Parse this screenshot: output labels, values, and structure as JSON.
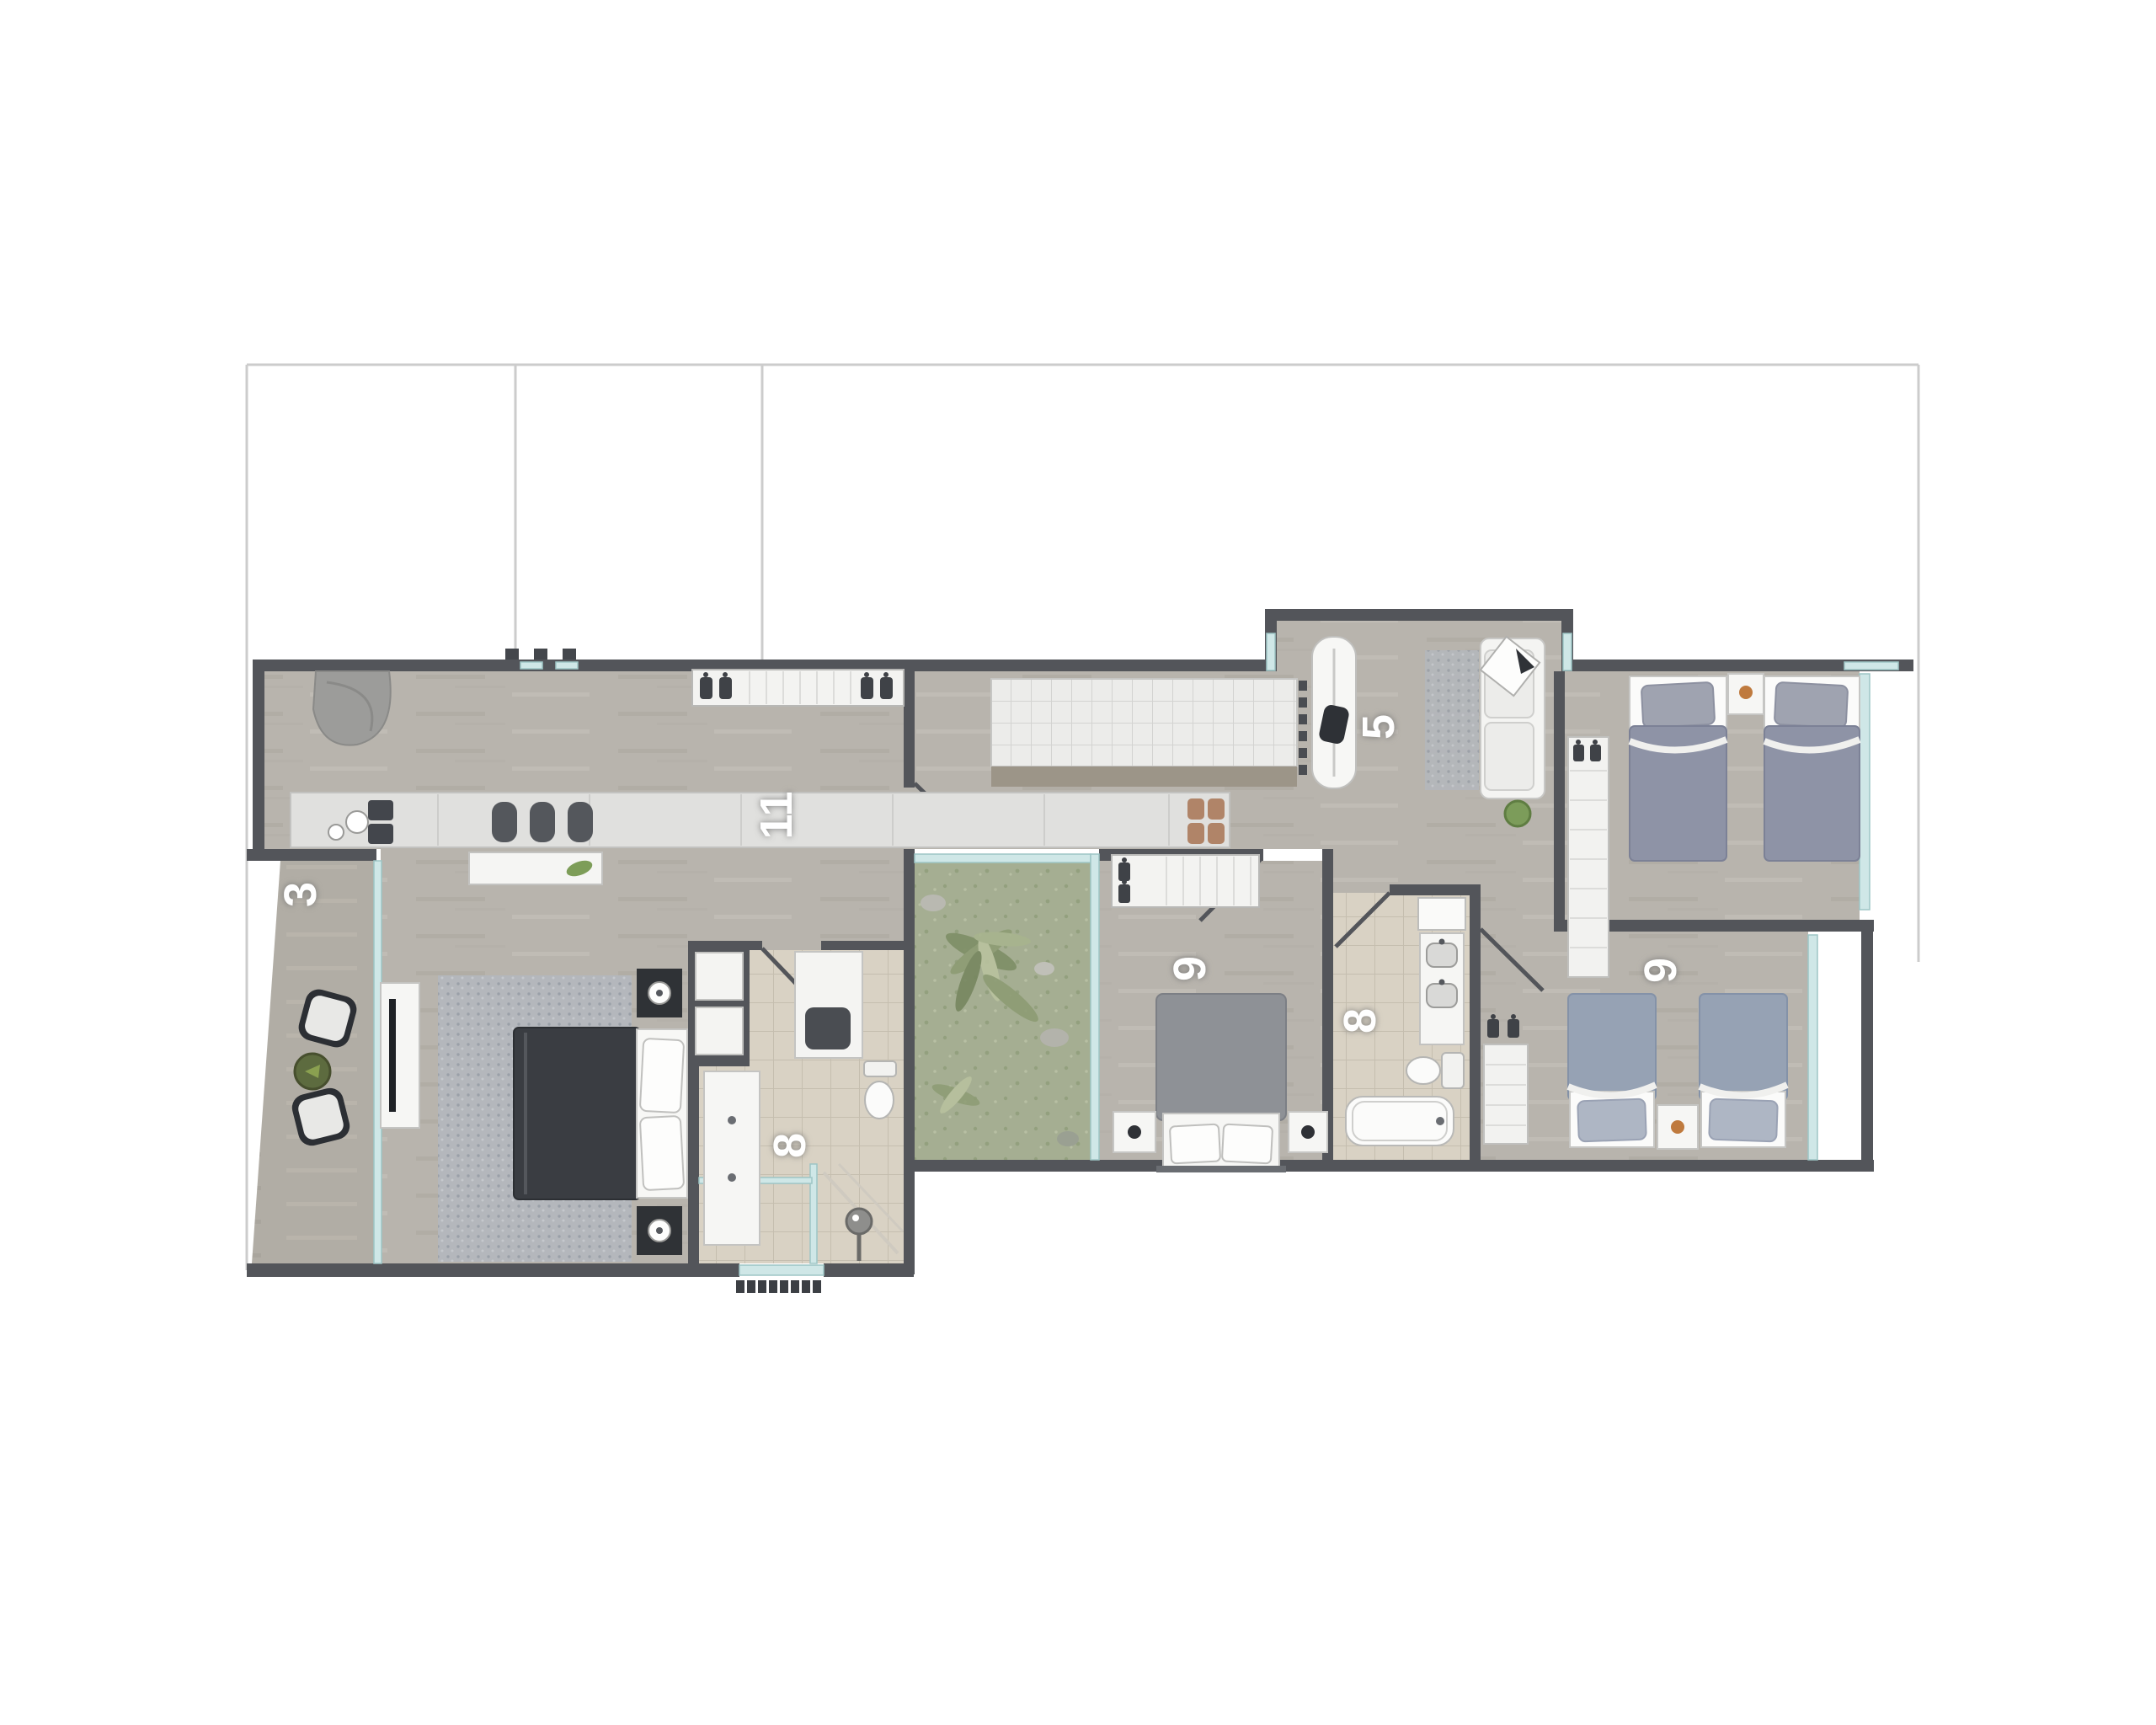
{
  "plan": {
    "type": "apartment-floor-plan",
    "background": "#ffffff",
    "rooms": [
      {
        "label": "3",
        "name": "terrace"
      },
      {
        "label": "11",
        "name": "living-kitchen"
      },
      {
        "label": "5",
        "name": "utility-room"
      },
      {
        "label": "9",
        "name": "bedroom-center"
      },
      {
        "label": "8",
        "name": "bathroom-master"
      },
      {
        "label": "8",
        "name": "bathroom-shared"
      },
      {
        "label": "9",
        "name": "bedroom-right"
      }
    ],
    "palette": {
      "wall": "#53555a",
      "wood_floor": "#b8b4ad",
      "terrace_floor": "#b1ada5",
      "bathroom_tile": "#d9d2c4",
      "garden_grass": "#a5ae92",
      "glass_window": "#cfe7e7",
      "boundary_line": "#cccccc",
      "label_text": "#ffffff",
      "white_furniture": "#f5f5f3",
      "dark_furniture": "#3a3d42",
      "bed_gray_blue": "#8e93a6",
      "accent_green": "#7d9d58",
      "accent_orange": "#bf7a3e"
    },
    "icons": [
      "clothes-hanger-icon",
      "table-lamp-icon",
      "plant-icon",
      "shower-drain-icon",
      "sink-icon",
      "toilet-icon",
      "bathtub-icon",
      "iron-icon",
      "stove-icon",
      "sofa-icon",
      "bed-icon",
      "chair-icon",
      "door-swing-icon",
      "entrance-mat-icon"
    ],
    "furniture": {
      "terrace": [
        "two chairs",
        "round plant table"
      ],
      "living-kitchen": [
        "curved bench",
        "kitchen counter with sink and cooktop",
        "bar stools",
        "sideboard with green decor",
        "wardrobe with hangers",
        "master double bed",
        "rug",
        "two nightstands with lamps",
        "tv console",
        "storage cabinet"
      ],
      "utility-room": [
        "ironing board with iron",
        "sofa with cushion",
        "rug",
        "plant"
      ],
      "bedroom-top-right": [
        "wardrobe",
        "two single beds",
        "nightstand"
      ],
      "bedroom-center": [
        "wardrobe with hangers",
        "double bed",
        "two nightstands with lamps"
      ],
      "bathroom-master": [
        "shelf niche",
        "washbasin counter",
        "counter with basin",
        "toilet",
        "shower with drain",
        "entrance mat"
      ],
      "bathroom-shared": [
        "appliance",
        "double washbasin vanity",
        "toilet",
        "bathtub"
      ],
      "bedroom-right": [
        "wardrobe with hangers",
        "two single beds",
        "nightstand"
      ],
      "courtyard": [
        "garden plants",
        "rocks"
      ]
    }
  }
}
